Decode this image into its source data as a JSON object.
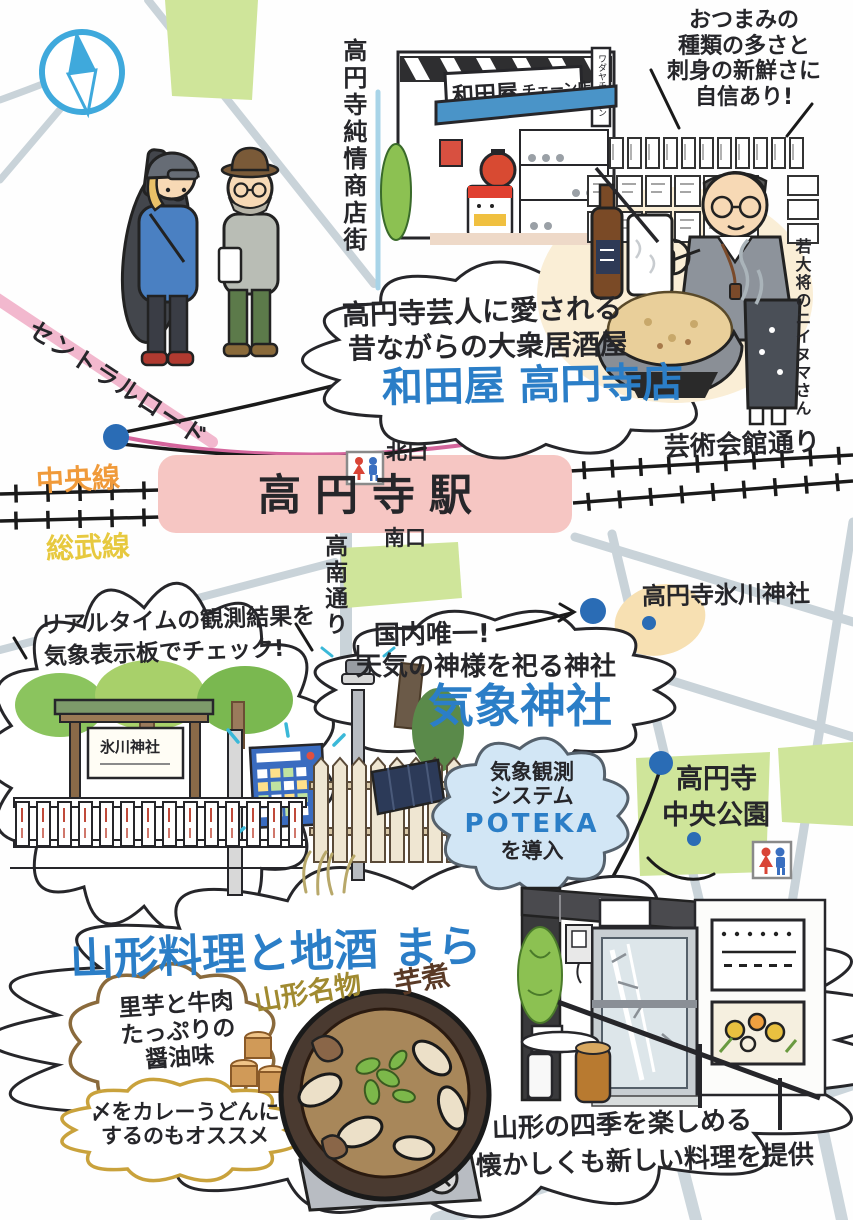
{
  "bubbles": {
    "tsumami": {
      "lines": [
        "おつまみの",
        "種類の多さと",
        "刺身の新鮮さに",
        "自信あり!"
      ]
    },
    "wadaya": {
      "line1": "高円寺芸人に愛される",
      "line2": "昔ながらの大衆居酒屋",
      "title": "和田屋 高円寺店"
    },
    "realtime": {
      "line1": "リアルタイムの観測結果を",
      "line2": "気象表示板でチェック!"
    },
    "kisho": {
      "line1": "国内唯一!",
      "line2": "天気の神様を祀る神社",
      "title": "気象神社"
    },
    "poteka": {
      "line1": "気象観測",
      "line2": "システム",
      "name": "POTEKA",
      "line3": "を導入"
    },
    "satoimo": {
      "lines": [
        "里芋と牛肉",
        "たっぷりの",
        "醤油味"
      ]
    },
    "shime": {
      "lines": [
        "〆をカレーうどんに",
        "するのもオススメ"
      ]
    },
    "mara_desc": {
      "line1": "山形の四季を楽しめる",
      "line2": "懐かしくも新しい料理を提供"
    }
  },
  "labels": {
    "shotengai": "高円寺純情商店街",
    "wakadaisho": "若大将のニイヌマさん",
    "central_road": "セントラルロード",
    "chuo_line": "中央線",
    "sobu_line": "総武線",
    "station": "高円寺駅",
    "north_exit": "北口",
    "south_exit": "南口",
    "geijutsu_street": "芸術会館通り",
    "konan_street": "高南通り",
    "hikawa_shrine": "高円寺氷川神社",
    "park_line1": "高円寺",
    "park_line2": "中央公園",
    "mara_title": "山形料理と地酒 まら",
    "meibutsu": "山形名物",
    "imoni": "芋煮"
  },
  "signs": {
    "store_main": "和田屋",
    "store_chain": "チェーン店",
    "store_corner": "ワダヤチェーン",
    "hikawa_board": "氷川神社"
  },
  "icons": {
    "compass": "compass-north-icon",
    "restroom_station": "restroom-icon",
    "restroom_park": "restroom-icon"
  },
  "colors": {
    "accent_blue": "#2b7ec7",
    "station_pink": "#f6c6c3",
    "chuo_orange": "#f09a3a",
    "sobu_yellow": "#e7c93f",
    "road_pink": "#f0b2cc",
    "park_green": "#cfe59a",
    "shrine_tan": "#f7e0b2",
    "compass_blue": "#3fa9dc",
    "dot_blue": "#2a6cb5"
  }
}
